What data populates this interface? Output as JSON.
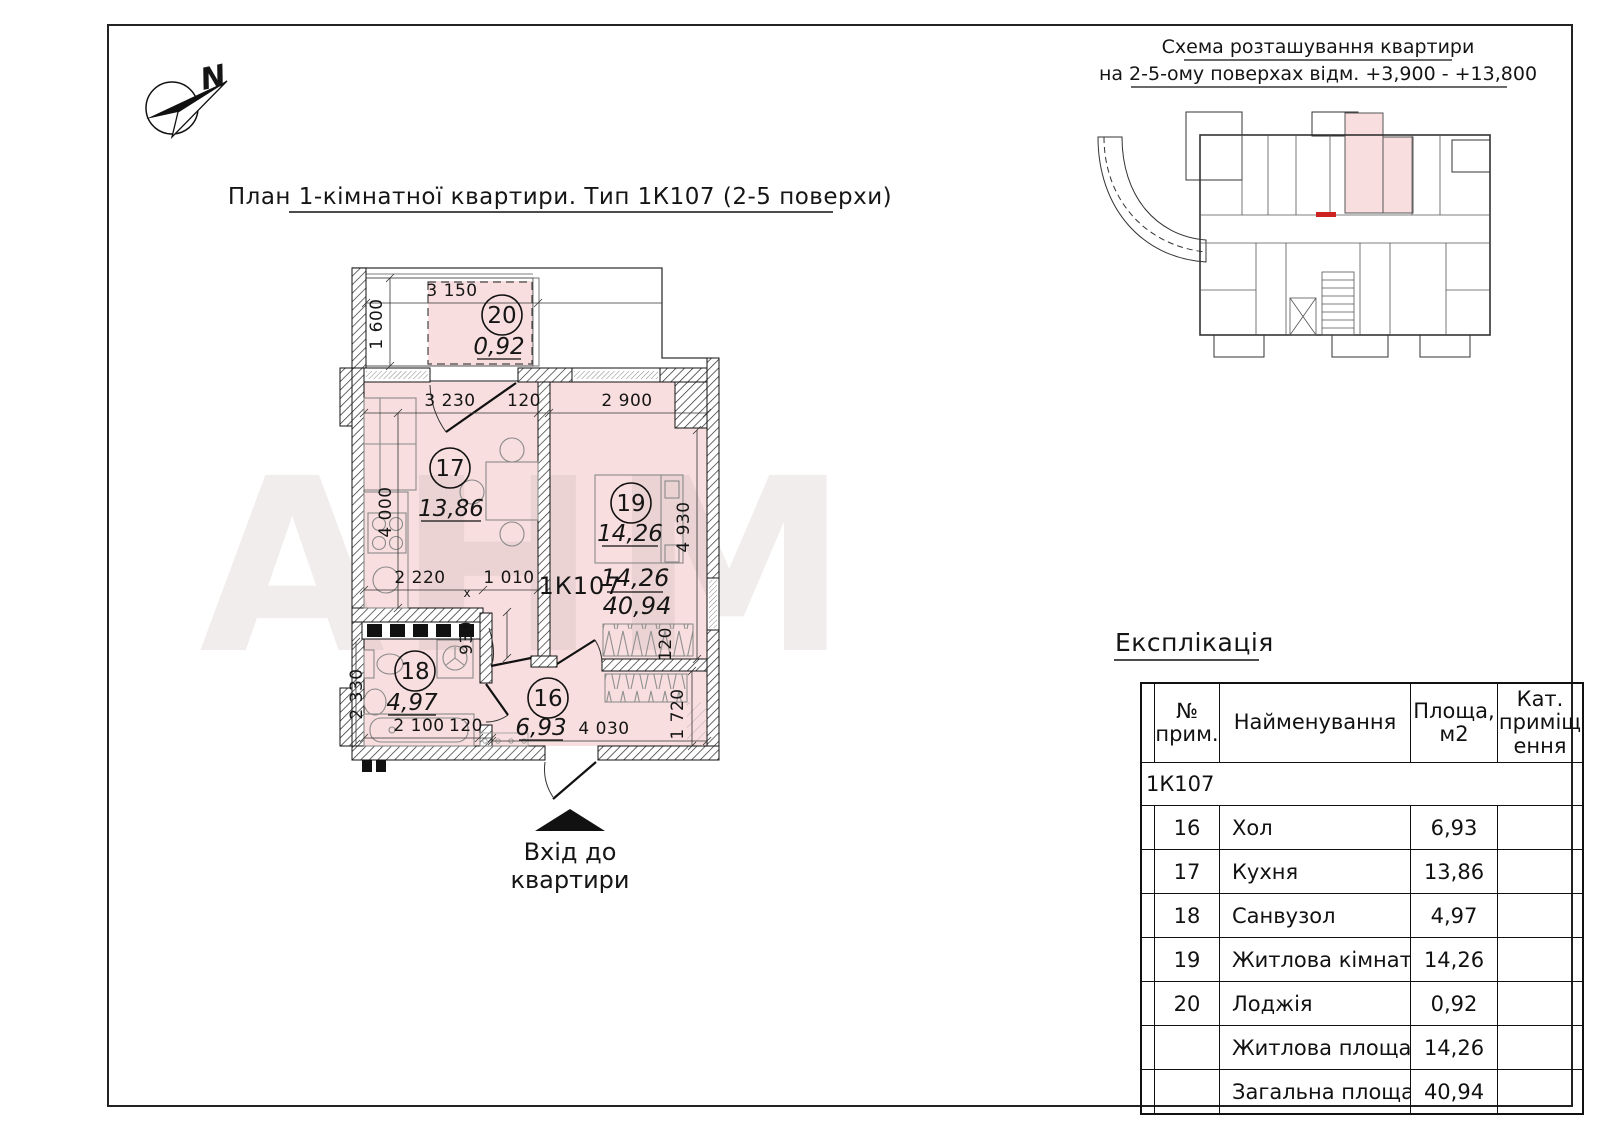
{
  "main_title": "План 1-кімнатної квартири. Тип 1К107 (2-5 поверхи)",
  "schematic": {
    "title_line1": "Схема розташування квартири",
    "title_line2": "на 2-5-ому поверхах відм. +3,900 - +13,800"
  },
  "compass": {
    "north_label": "N"
  },
  "entrance": {
    "line1": "Вхід до",
    "line2": "квартири"
  },
  "watermark": "АНМ",
  "plan": {
    "type_code": "1К107",
    "area_living": "14,26",
    "area_total": "40,94",
    "rooms": {
      "r20": {
        "num": "20",
        "area": "0,92"
      },
      "r17": {
        "num": "17",
        "area": "13,86"
      },
      "r19": {
        "num": "19",
        "area": "14,26"
      },
      "r18": {
        "num": "18",
        "area": "4,97"
      },
      "r16": {
        "num": "16",
        "area": "6,93"
      }
    },
    "dims": {
      "loggia_w": "3 150",
      "loggia_d": "1 600",
      "kitchen_w": "3 230",
      "kitchen_wall": "120",
      "room19_w": "2 900",
      "kitchen_d": "4 000",
      "room19_d": "4 930",
      "counter_w": "2 220",
      "kdoor_w": "1 010",
      "hdoor_w": "930",
      "bath_w": "2 100",
      "bath_wall": "120",
      "bath_d": "2 330",
      "hall_w": "4 030",
      "closet_d": "1 720",
      "closet_g": "120",
      "xmark": "х"
    }
  },
  "explication": {
    "title": "Експлікація",
    "headers": {
      "no_1": "№",
      "no_2": "прим.",
      "name": "Найменування",
      "area_1": "Площа,",
      "area_2": "м2",
      "cat_1": "Кат.",
      "cat_2": "приміщ",
      "cat_3": "ення"
    },
    "group": "1К107",
    "rows": [
      {
        "no": "16",
        "name": "Хол",
        "area": "6,93",
        "cat": ""
      },
      {
        "no": "17",
        "name": "Кухня",
        "area": "13,86",
        "cat": ""
      },
      {
        "no": "18",
        "name": "Санвузол",
        "area": "4,97",
        "cat": ""
      },
      {
        "no": "19",
        "name": "Житлова кімната",
        "area": "14,26",
        "cat": ""
      },
      {
        "no": "20",
        "name": "Лоджія",
        "area": "0,92",
        "cat": ""
      },
      {
        "no": "",
        "name": "Житлова площа",
        "area": "14,26",
        "cat": ""
      },
      {
        "no": "",
        "name": "Загальна площа",
        "area": "40,94",
        "cat": ""
      }
    ]
  },
  "colors": {
    "room_fill": "#f8dede",
    "line": "#151515",
    "red_mark": "#cc2222"
  }
}
